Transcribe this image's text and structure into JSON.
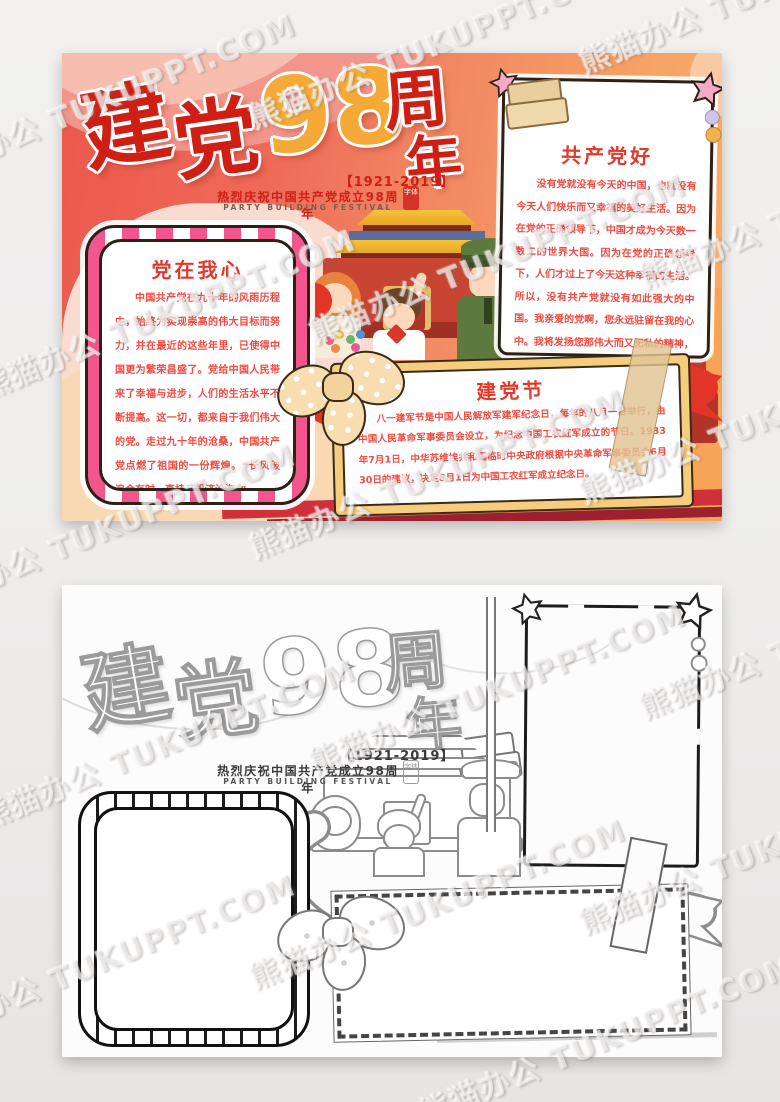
{
  "watermark": {
    "text": "熊猫办公 TUKUPPT.COM"
  },
  "poster": {
    "title": {
      "char1": "建",
      "char2": "党",
      "number": "98",
      "char3": "周",
      "char4": "年"
    },
    "subtitle": {
      "years": "【1921-2019】",
      "cn": "热烈庆祝中国共产党成立98周年",
      "en": "PARTY BUILDING FESTIVAL",
      "seal": "字体"
    },
    "sections": {
      "left": {
        "title": "党在我心",
        "body": "中国共产党在九十年的风雨历程中，始终为实现崇高的伟大目标而努力，并在最近的这些年里，已使得中国更为繁荣昌盛了。党给中国人民带来了幸福与进步，人们的生活水平不断提高。这一切，都来自于我们伟大的党。走过九十年的沧桑，中国共产党点燃了祖国的一份辉煌。“长风破浪会有时，直挂云帆济沧海。”。"
      },
      "right": {
        "title": "共产党好",
        "body": "没有党就没有今天的中国，也就没有今天人们快乐而又幸福的美好生活。因为在党的正确领导下，中国才成为今天数一数二的世界大国。因为在党的正确领导下，人们才过上了今天这种幸福的生活。所以，没有共产党就没有如此强大的中国。我亲爱的党啊，您永远驻留在我的心中。我将发扬您那伟大而又无私的精神，成一名爱国、爱党的优秀少先队员。"
      },
      "banner": {
        "title": "建党节",
        "body": "八一建军节是中国人民解放军建军纪念日，每年的八月一日举行，由中国人民革命军事委员会设立，为纪念中国工农红军成立的节日。1933年7月1日，中华苏维埃共和国临时中央政府根据中央革命军事委员会6月30日的建议，决定8月1日为中国工农红军成立纪念日。"
      }
    }
  },
  "colors": {
    "title_red": "#cf1f14",
    "title_gold": "#f5aa38",
    "body_red": "#ef4b41",
    "pink_frame": "#f2568c",
    "banner_frame": "#f6cd7c",
    "ribbon_red": "#e23427",
    "poster_gradient_left": "#ec584c",
    "poster_gradient_right": "#f7ad68",
    "page_background": "#efeeed"
  }
}
